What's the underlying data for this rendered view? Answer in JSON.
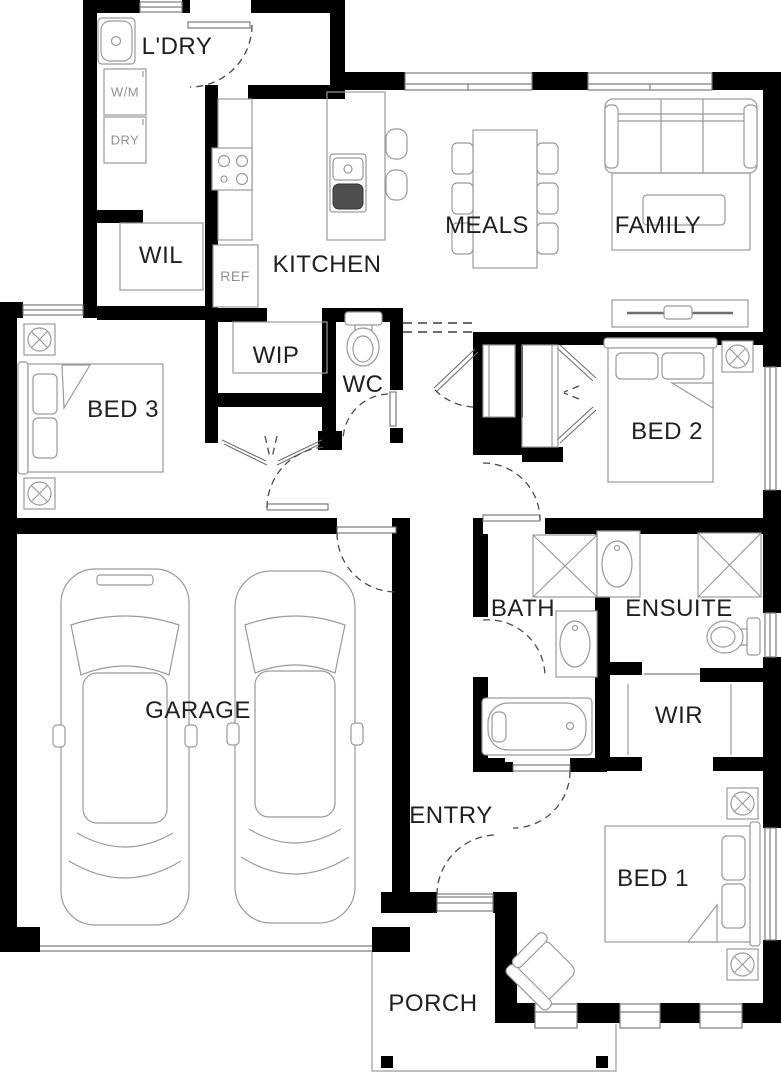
{
  "plan": {
    "title": "single-storey house floor plan",
    "rooms": {
      "laundry": "L'DRY",
      "wil": "WIL",
      "kitchen": "KITCHEN",
      "wip": "WIP",
      "wc": "WC",
      "meals": "MEALS",
      "family": "FAMILY",
      "bed3": "BED 3",
      "bed2": "BED 2",
      "bath": "BATH",
      "ensuite": "ENSUITE",
      "garage": "GARAGE",
      "wir": "WIR",
      "entry": "ENTRY",
      "bed1": "BED 1",
      "porch": "PORCH"
    },
    "appliances": {
      "washing_machine": "W/M",
      "dryer": "DRY",
      "fridge": "REF"
    },
    "colors": {
      "wall": "#000000",
      "furniture_line": "#9A9A9A",
      "door_arc": "#4A4A4A",
      "label": "#1F1F1F",
      "muted_label": "#8F8F8F",
      "background": "#FFFFFF"
    }
  }
}
